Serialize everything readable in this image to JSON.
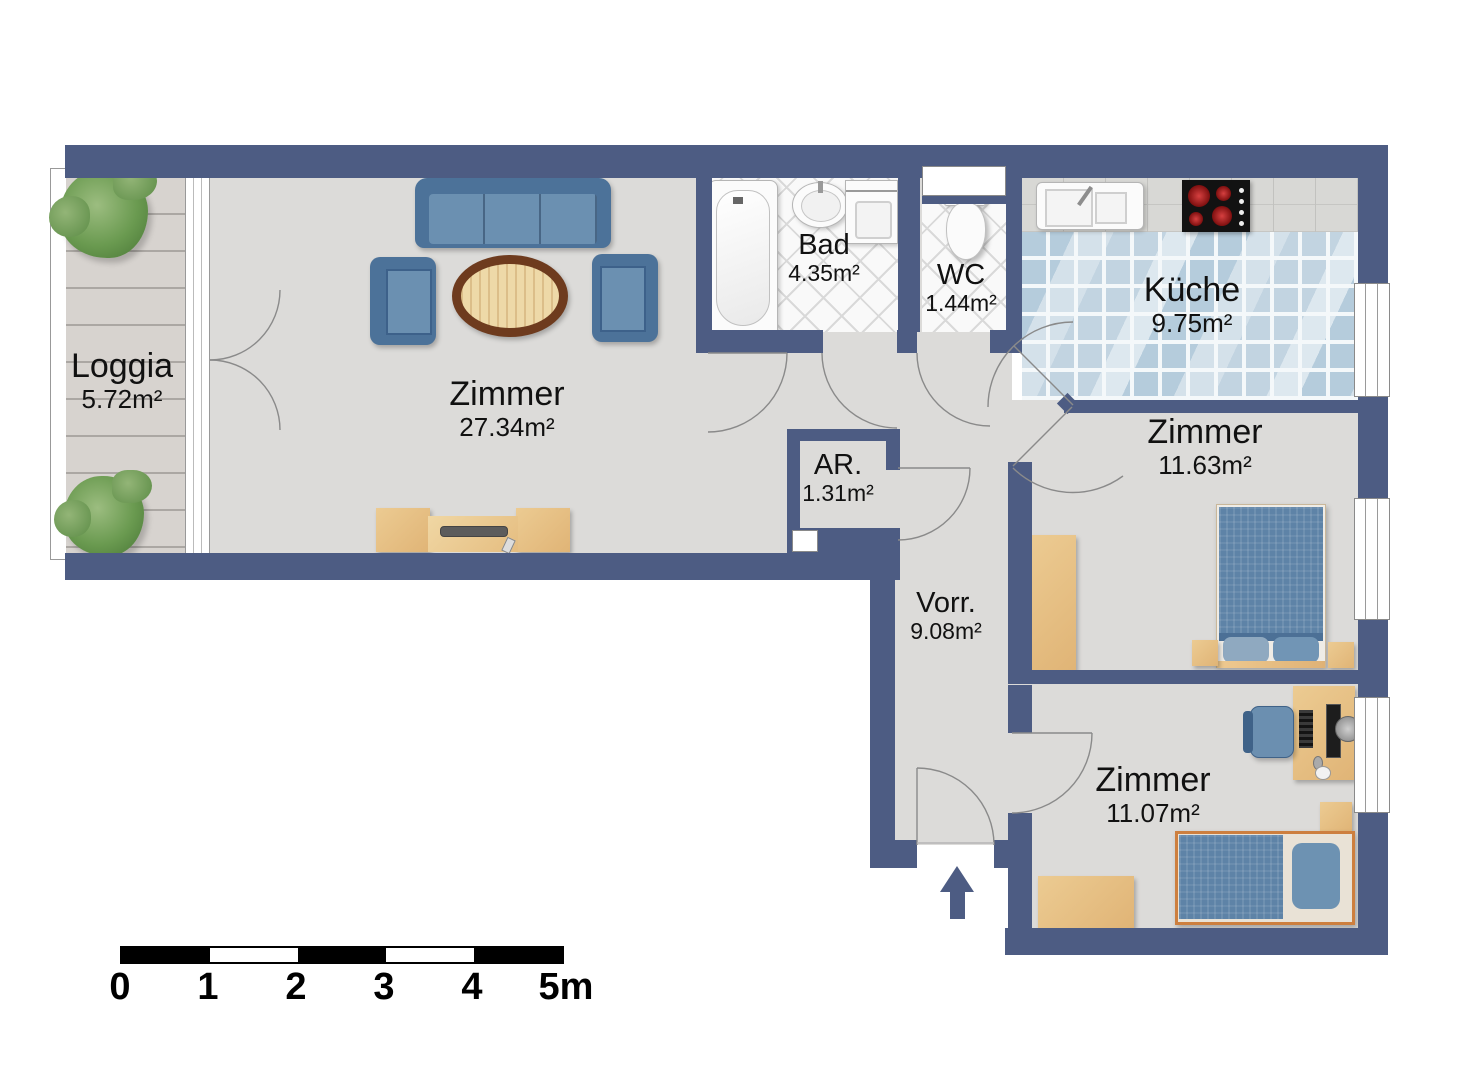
{
  "rooms": {
    "loggia": {
      "name": "Loggia",
      "area": "5.72m²"
    },
    "living_room": {
      "name": "Zimmer",
      "area": "27.34m²"
    },
    "bathroom": {
      "name": "Bad",
      "area": "4.35m²"
    },
    "wc": {
      "name": "WC",
      "area": "1.44m²"
    },
    "kitchen": {
      "name": "Küche",
      "area": "9.75m²"
    },
    "storage": {
      "name": "AR.",
      "area": "1.31m²"
    },
    "hallway": {
      "name": "Vorr.",
      "area": "9.08m²"
    },
    "bedroom_1": {
      "name": "Zimmer",
      "area": "11.63m²"
    },
    "bedroom_2": {
      "name": "Zimmer",
      "area": "11.07m²"
    }
  },
  "scale_bar": {
    "ticks": [
      "0",
      "1",
      "2",
      "3",
      "4",
      "5m"
    ]
  },
  "colors": {
    "wall": "#4d5c83",
    "floor": "#dcdbd9",
    "deck": "#d7d3cf",
    "bath_tile": "#f9f9f9",
    "kitchen_tile": "#c9d8e4",
    "counter": "#d8d8d5",
    "wood": "#eccb92",
    "wood_dark": "#6e3b1e",
    "upholstery": "#5f86aa",
    "bedding": "#5e83a7",
    "plant": "#6a9a50",
    "arc": "#8a8a8a",
    "scale": "#000000"
  }
}
